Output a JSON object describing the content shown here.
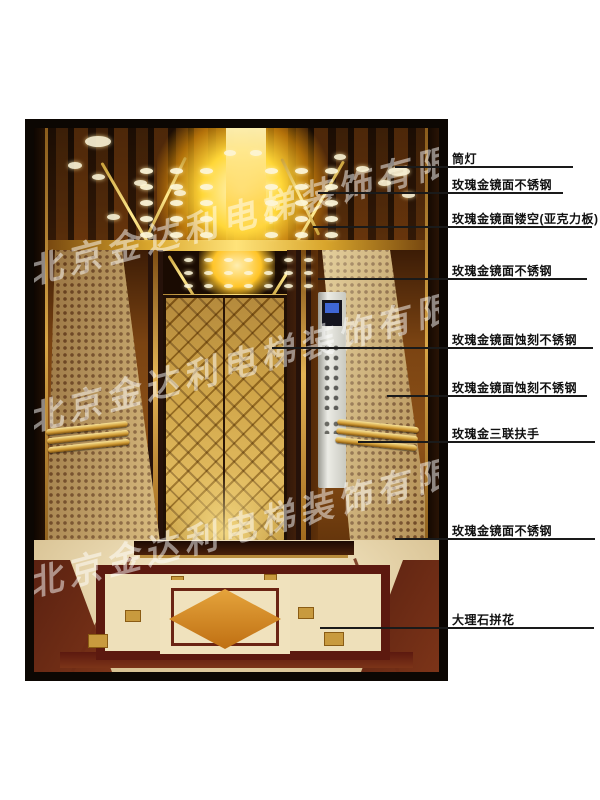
{
  "figure": {
    "title": "elevator cab interior annotated product diagram",
    "watermark_text": "北京金达利电梯装饰有限公司"
  },
  "annotations": [
    {
      "label": "筒灯",
      "text_x": 452,
      "text_y": 150,
      "line": {
        "x1": 395,
        "x2": 573,
        "y": 166
      }
    },
    {
      "label": "玫瑰金镜面不锈钢",
      "text_x": 452,
      "text_y": 176,
      "line": {
        "x1": 318,
        "x2": 563,
        "y": 192
      }
    },
    {
      "label": "玫瑰金镜面镂空(亚克力板)",
      "text_x": 452,
      "text_y": 210,
      "line": {
        "x1": 313,
        "x2": 592,
        "y": 226
      }
    },
    {
      "label": "玫瑰金镜面不锈钢",
      "text_x": 452,
      "text_y": 262,
      "line": {
        "x1": 318,
        "x2": 587,
        "y": 278
      }
    },
    {
      "label": "玫瑰金镜面蚀刻不锈钢",
      "text_x": 452,
      "text_y": 331,
      "line": {
        "x1": 272,
        "x2": 593,
        "y": 347
      }
    },
    {
      "label": "玫瑰金镜面蚀刻不锈钢",
      "text_x": 452,
      "text_y": 379,
      "line": {
        "x1": 387,
        "x2": 587,
        "y": 395
      }
    },
    {
      "label": "玫瑰金三联扶手",
      "text_x": 452,
      "text_y": 425,
      "line": {
        "x1": 358,
        "x2": 595,
        "y": 441
      }
    },
    {
      "label": "玫瑰金镜面不锈钢",
      "text_x": 452,
      "text_y": 522,
      "line": {
        "x1": 395,
        "x2": 595,
        "y": 538
      }
    },
    {
      "label": "大理石拼花",
      "text_x": 452,
      "text_y": 611,
      "line": {
        "x1": 320,
        "x2": 594,
        "y": 627
      }
    }
  ],
  "colors": {
    "background": "#ffffff",
    "annotation_line": "#1a1a1a",
    "label_text": "#111111",
    "frame": "#0c0703",
    "gold_accent": "#d8a52c",
    "marble_red": "#5c190f",
    "marble_cream": "#e9d8b0",
    "diamond_orange": "#d4822a",
    "watermark": "rgba(255,255,255,0.5)"
  }
}
